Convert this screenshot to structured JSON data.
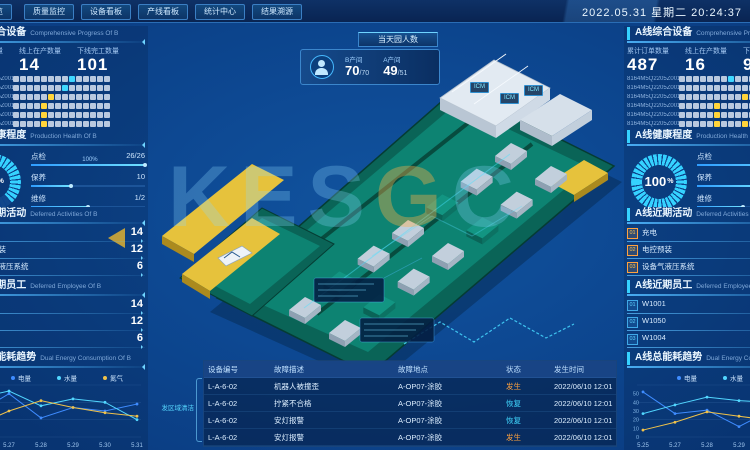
{
  "topbar": {
    "menu_stub": "览",
    "menu": [
      "质量监控",
      "设备看板",
      "产线看板",
      "统计中心",
      "结果溯源"
    ],
    "datetime": "2022.05.31 星期二 20:24:37"
  },
  "people": {
    "tab": "当天园人数",
    "groups": [
      {
        "label": "B产间",
        "value": "70",
        "total": "/70"
      },
      {
        "label": "A产间",
        "value": "49",
        "total": "/51"
      }
    ]
  },
  "panels": {
    "left": {
      "progress": {
        "title": "B线综合设备",
        "subtitle": "Comprehensive Progress Of B",
        "stats": [
          {
            "label": "累计订单数量",
            "value": "8"
          },
          {
            "label": "线上在产数量",
            "value": "14"
          },
          {
            "label": "下线完工数量",
            "value": "101"
          }
        ],
        "rows": [
          "8164M5Q2205Z0010",
          "8164M5Q2205Z0011",
          "8164M5Q2205Z0012",
          "8164M5Q2205Z0013",
          "8164M5Q2205Z0014",
          "8164M5Q2205Z0015"
        ],
        "cells_per_row": 14,
        "highlights": [
          [
            0,
            8,
            "c"
          ],
          [
            1,
            7,
            "c"
          ],
          [
            2,
            5,
            "y"
          ],
          [
            3,
            4,
            "y"
          ],
          [
            4,
            4,
            "y"
          ],
          [
            5,
            4,
            "y"
          ]
        ],
        "legend": [
          "总数N",
          "款一",
          "在产",
          "款二",
          "待检",
          "完工下线"
        ]
      },
      "health": {
        "title": "B线健康程度",
        "subtitle": "Production Health Of B",
        "gauge": 63,
        "gauge_unit": "%",
        "metrics": [
          {
            "label": "点检",
            "value": "26/26",
            "pct": 100,
            "note": "100%"
          },
          {
            "label": "保养",
            "value": "10",
            "pct": 35,
            "note": ""
          },
          {
            "label": "维修",
            "value": "1/2",
            "pct": 50,
            "note": ""
          }
        ]
      },
      "activities": {
        "title": "B线近期活动",
        "subtitle": "Deferred Activities Of B",
        "items": [
          {
            "label": "充电",
            "value": "14"
          },
          {
            "label": "电控预装",
            "value": "12"
          },
          {
            "label": "设备气液压系统",
            "value": "6"
          }
        ]
      },
      "employees": {
        "title": "B线近期员工",
        "subtitle": "Deferred Employee Of B",
        "items": [
          {
            "label": "W1001",
            "value": "14"
          },
          {
            "label": "W1050",
            "value": "12"
          },
          {
            "label": "W1004",
            "value": "6"
          }
        ]
      },
      "energy": {
        "title": "B线总能耗趋势",
        "subtitle": "Dual Energy Consumption Of B"
      }
    },
    "right": {
      "progress": {
        "title": "A线综合设备",
        "subtitle": "Comprehensive Progress Of A",
        "stats": [
          {
            "label": "累计订单数量",
            "value": "487"
          },
          {
            "label": "线上在产数量",
            "value": "16"
          },
          {
            "label": "下线完工数量",
            "value": "94"
          }
        ],
        "rows": [
          "8164M5Q2205Z0010",
          "8164M5Q2205Z0011",
          "8164M5Q2205Z0012",
          "8164M5Q2205Z0013",
          "8164M5Q2205Z0014",
          "8164M5Q2205Z0015"
        ],
        "cells_per_row": 14,
        "highlights": [
          [
            0,
            7,
            "c"
          ],
          [
            2,
            9,
            "y"
          ],
          [
            3,
            5,
            "y"
          ],
          [
            4,
            5,
            "y"
          ],
          [
            5,
            5,
            "y"
          ],
          [
            5,
            9,
            "y"
          ]
        ],
        "legend": [
          "总数N",
          "款一",
          "在产",
          "款二",
          "待检",
          "完工下线"
        ]
      },
      "health": {
        "title": "A线健康程度",
        "subtitle": "Production Health Of A",
        "gauge": 100,
        "gauge_unit": "%",
        "metrics": [
          {
            "label": "点检",
            "value": "",
            "pct": 100,
            "note": ""
          },
          {
            "label": "保养",
            "value": "",
            "pct": 60,
            "note": ""
          },
          {
            "label": "维修",
            "value": "",
            "pct": 40,
            "note": ""
          }
        ]
      },
      "activities": {
        "title": "A线近期活动",
        "subtitle": "Deferred Activities Of A",
        "items": [
          {
            "label": "充电",
            "value": ""
          },
          {
            "label": "电控预装",
            "value": ""
          },
          {
            "label": "设备气液压系统",
            "value": ""
          }
        ]
      },
      "employees": {
        "title": "A线近期员工",
        "subtitle": "Deferred Employee Of A",
        "items": [
          {
            "label": "W1001",
            "value": ""
          },
          {
            "label": "W1050",
            "value": ""
          },
          {
            "label": "W1004",
            "value": ""
          }
        ]
      },
      "energy": {
        "title": "A线总能耗趋势",
        "subtitle": "Dual Energy Consumption Of A"
      }
    }
  },
  "chart_data": [
    {
      "type": "line",
      "title": "B线总能耗趋势",
      "legend_position": "top-right",
      "x": [
        "5.25",
        "5.27",
        "5.28",
        "5.29",
        "5.30",
        "5.31"
      ],
      "ylim": [
        0,
        60
      ],
      "yticks": [],
      "series": [
        {
          "name": "电量",
          "color": "#3f8cff",
          "values": [
            28,
            50,
            22,
            34,
            30,
            38
          ]
        },
        {
          "name": "水量",
          "color": "#52d7ff",
          "values": [
            45,
            53,
            36,
            44,
            40,
            20
          ]
        },
        {
          "name": "氮气",
          "color": "#f0c24a",
          "values": [
            14,
            30,
            42,
            34,
            28,
            24
          ]
        }
      ]
    },
    {
      "type": "line",
      "title": "A线总能耗趋势",
      "legend_position": "top-right",
      "x": [
        "5.25",
        "5.27",
        "5.28",
        "5.29",
        "5.30",
        "5.31"
      ],
      "ylim": [
        0,
        60
      ],
      "yticks": [
        50,
        40,
        30,
        20,
        10,
        0
      ],
      "series": [
        {
          "name": "电量",
          "color": "#3f8cff",
          "values": [
            52,
            27,
            31,
            12,
            31,
            22
          ]
        },
        {
          "name": "水量",
          "color": "#52d7ff",
          "values": [
            27,
            37,
            46,
            42,
            40,
            33
          ]
        },
        {
          "name": "氮气",
          "color": "#f0c24a",
          "values": [
            8,
            17,
            29,
            24,
            19,
            12
          ]
        }
      ]
    }
  ],
  "table": {
    "region_label": "发区域清洁",
    "columns": [
      "设备编号",
      "故障描述",
      "故障地点",
      "状态",
      "发生时间"
    ],
    "col_widths": [
      58,
      116,
      100,
      40,
      86
    ],
    "rows": [
      {
        "id": "L-A-6-02",
        "desc": "机器人被撞歪",
        "loc": "A-OP07-涂胶",
        "status": "发生",
        "status_color": "#ffa23e",
        "time": "2022/06/10 12:01"
      },
      {
        "id": "L-A-6-02",
        "desc": "拧紧不合格",
        "loc": "A-OP07-涂胶",
        "status": "恢复",
        "status_color": "#41d8ff",
        "time": "2022/06/10 12:01"
      },
      {
        "id": "L-A-6-02",
        "desc": "安灯报警",
        "loc": "A-OP07-涂胶",
        "status": "恢复",
        "status_color": "#41d8ff",
        "time": "2022/06/10 12:01"
      },
      {
        "id": "L-A-6-02",
        "desc": "安灯报警",
        "loc": "A-OP07-涂胶",
        "status": "发生",
        "status_color": "#ffa23e",
        "time": "2022/06/10 12:01"
      }
    ]
  },
  "scene": {
    "tags": [
      "ICM",
      "ICM",
      "ICM"
    ]
  },
  "watermark": "KESGC",
  "colors": {
    "accent": "#35d2ff",
    "yellow": "#ffd43a",
    "orange": "#ffa23e",
    "platform": "#0d8372",
    "pier": "#e6c23c"
  }
}
